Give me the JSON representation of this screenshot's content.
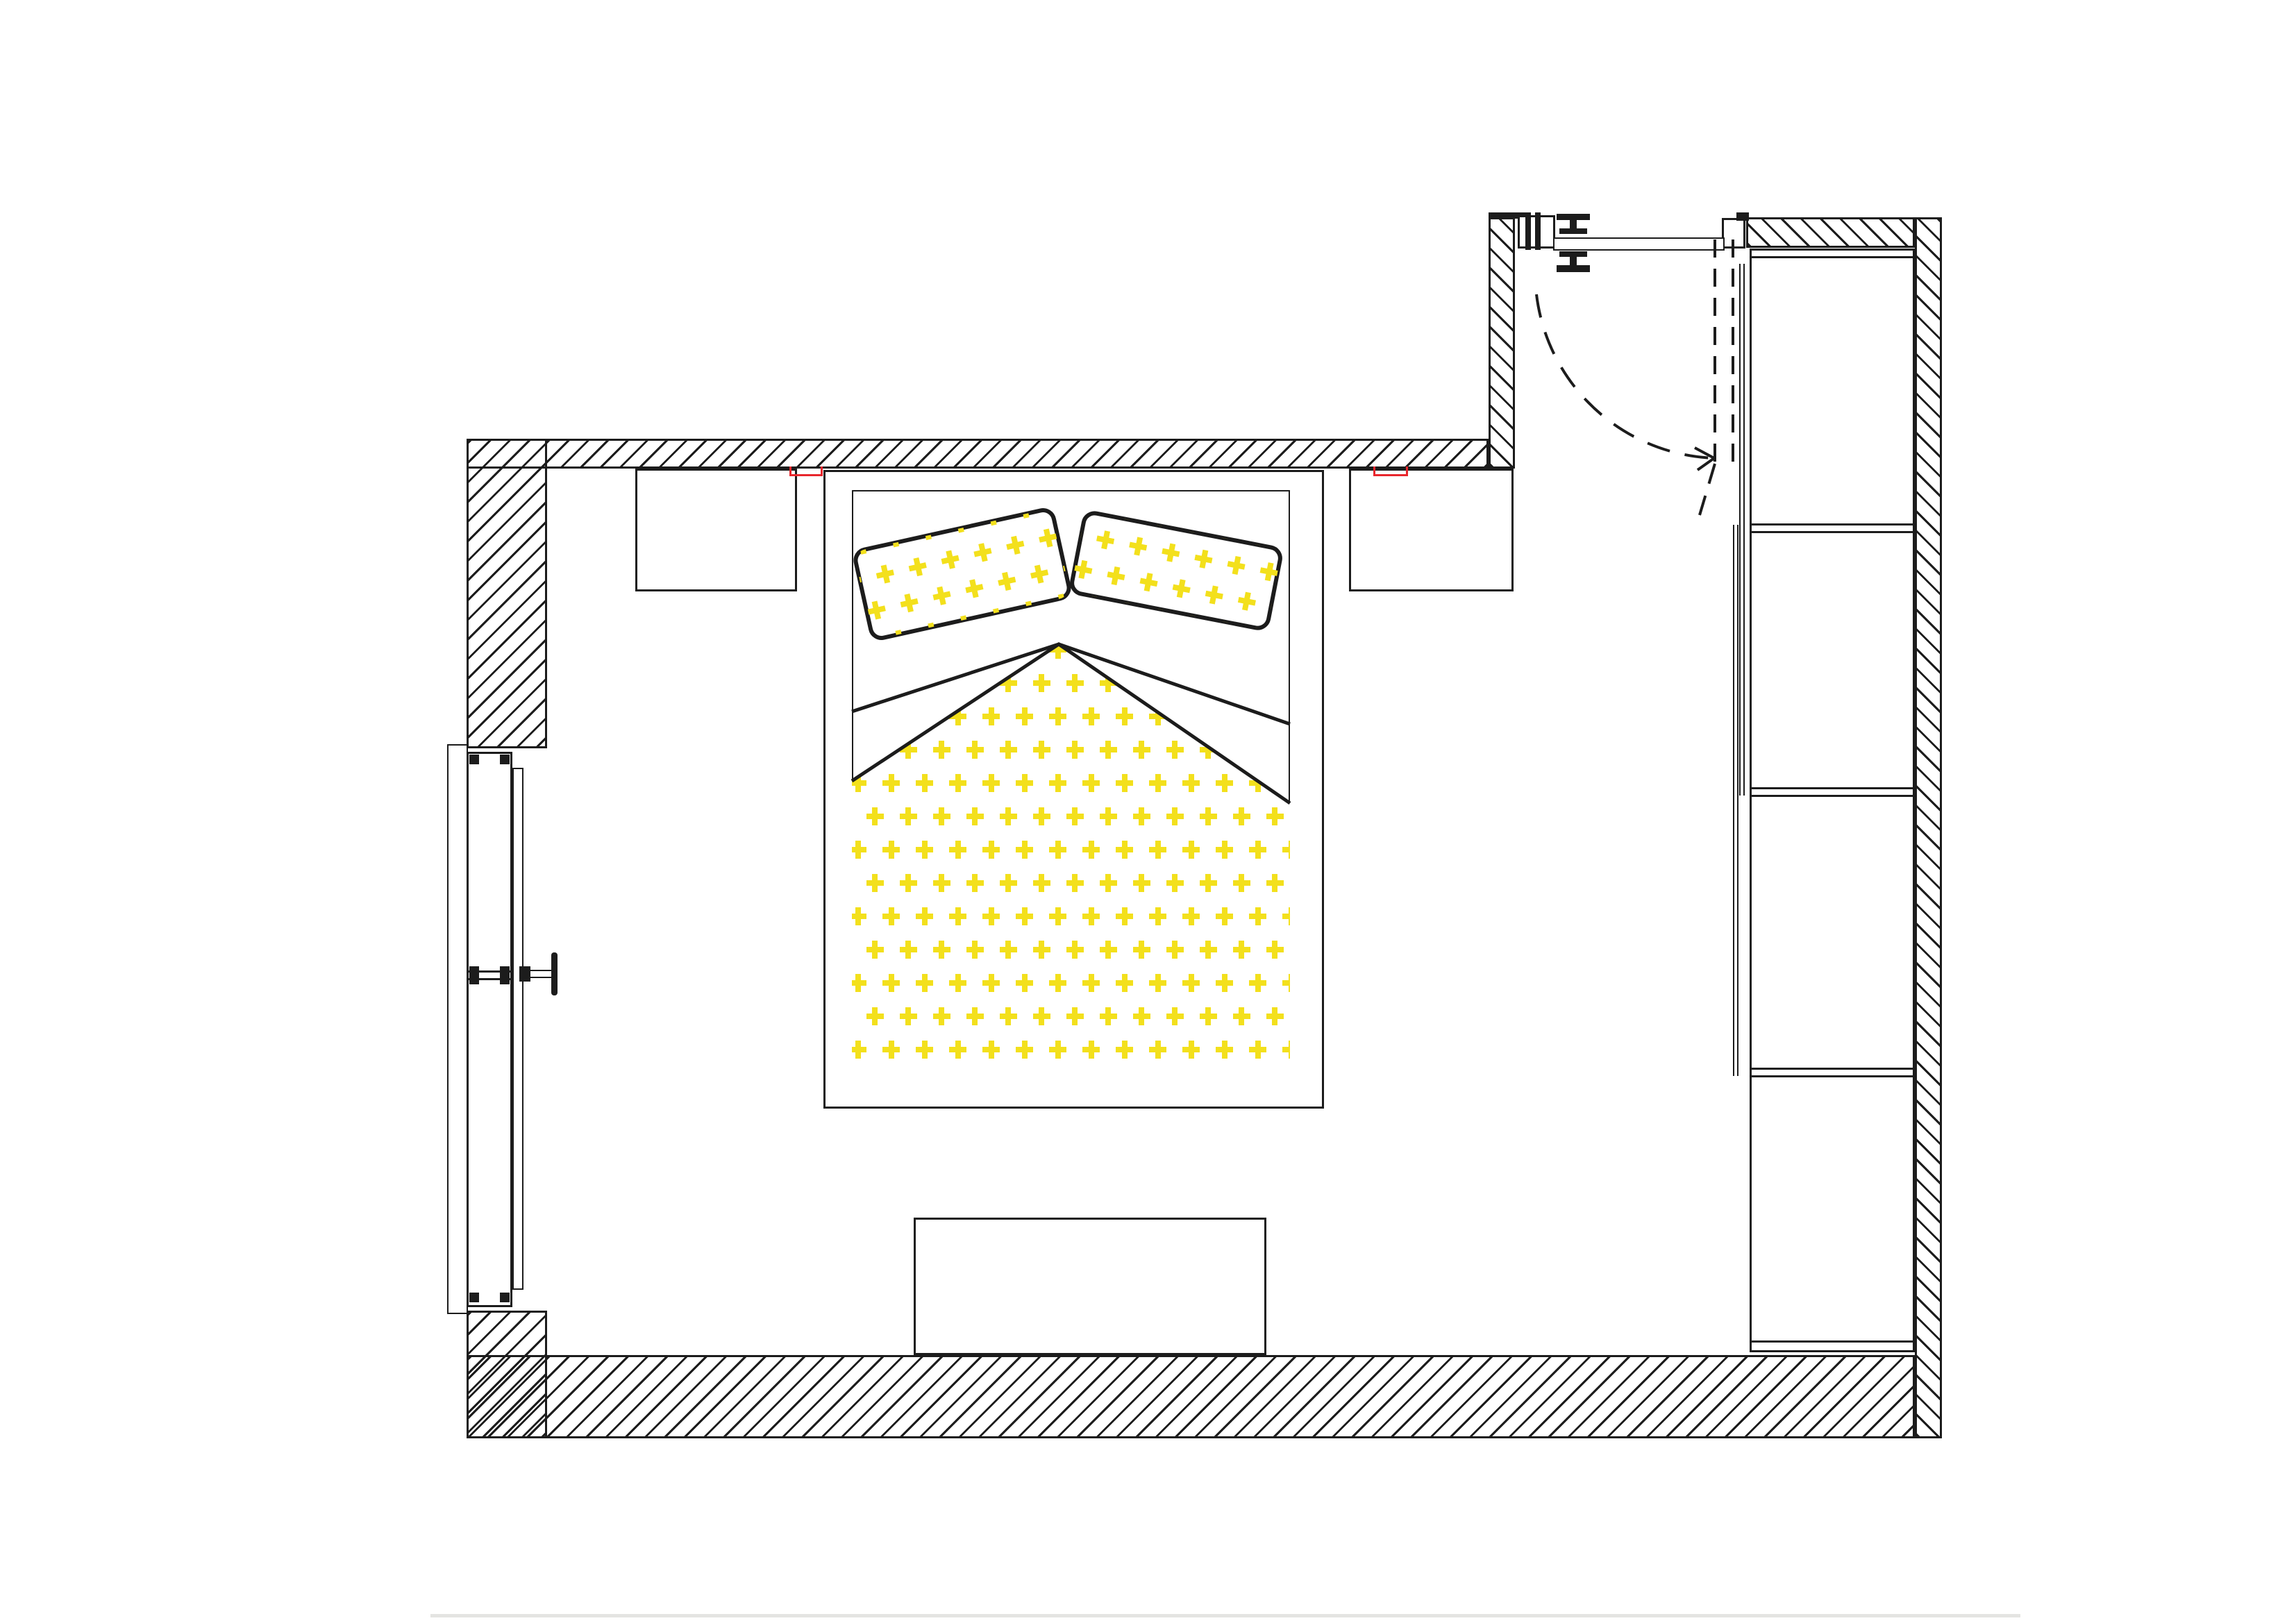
{
  "document": {
    "kind": "scanned architectural floor plan",
    "room": "bedroom",
    "text_visible": "",
    "palette": {
      "line_black": "#1c1c1c",
      "paper_white": "#ffffff",
      "fabric_pattern_yellow": "#f3e01c",
      "marker_red": "#e8262c",
      "scan_artifact_gray": "#d8d8d6"
    }
  },
  "inventory": {
    "walls": [
      {
        "name": "left-wall",
        "hatch": "diagonal"
      },
      {
        "name": "top-wall",
        "hatch": "diagonal"
      },
      {
        "name": "bottom-wall",
        "hatch": "diagonal"
      },
      {
        "name": "right-wall",
        "hatch": "diagonal"
      },
      {
        "name": "entry-partition-wall",
        "hatch": "diagonal"
      },
      {
        "name": "entry-top-wall",
        "hatch": "diagonal"
      }
    ],
    "openings": [
      {
        "name": "window",
        "wall": "left",
        "parts": [
          "sill-board",
          "frame",
          "glazing",
          "crank-handle"
        ]
      },
      {
        "name": "entry-door",
        "wall": "top-right",
        "parts": [
          "hinge-symbols",
          "door-leaf",
          "swing-arc-dashed",
          "open-leaf-dashed"
        ]
      }
    ],
    "furniture": [
      {
        "name": "double-bed",
        "decor": "yellow plus-pattern duvet and two pillows"
      },
      {
        "name": "pillow-left",
        "pattern": "yellow-plus"
      },
      {
        "name": "pillow-right",
        "pattern": "yellow-plus"
      },
      {
        "name": "nightstand-left"
      },
      {
        "name": "nightstand-right"
      },
      {
        "name": "wardrobe",
        "sections": 4,
        "front": "sliding-doors"
      },
      {
        "name": "low-dresser-bench"
      }
    ],
    "annotations": [
      {
        "name": "red-mark-left",
        "color": "#e8262c"
      },
      {
        "name": "red-mark-right",
        "color": "#e8262c"
      }
    ]
  }
}
